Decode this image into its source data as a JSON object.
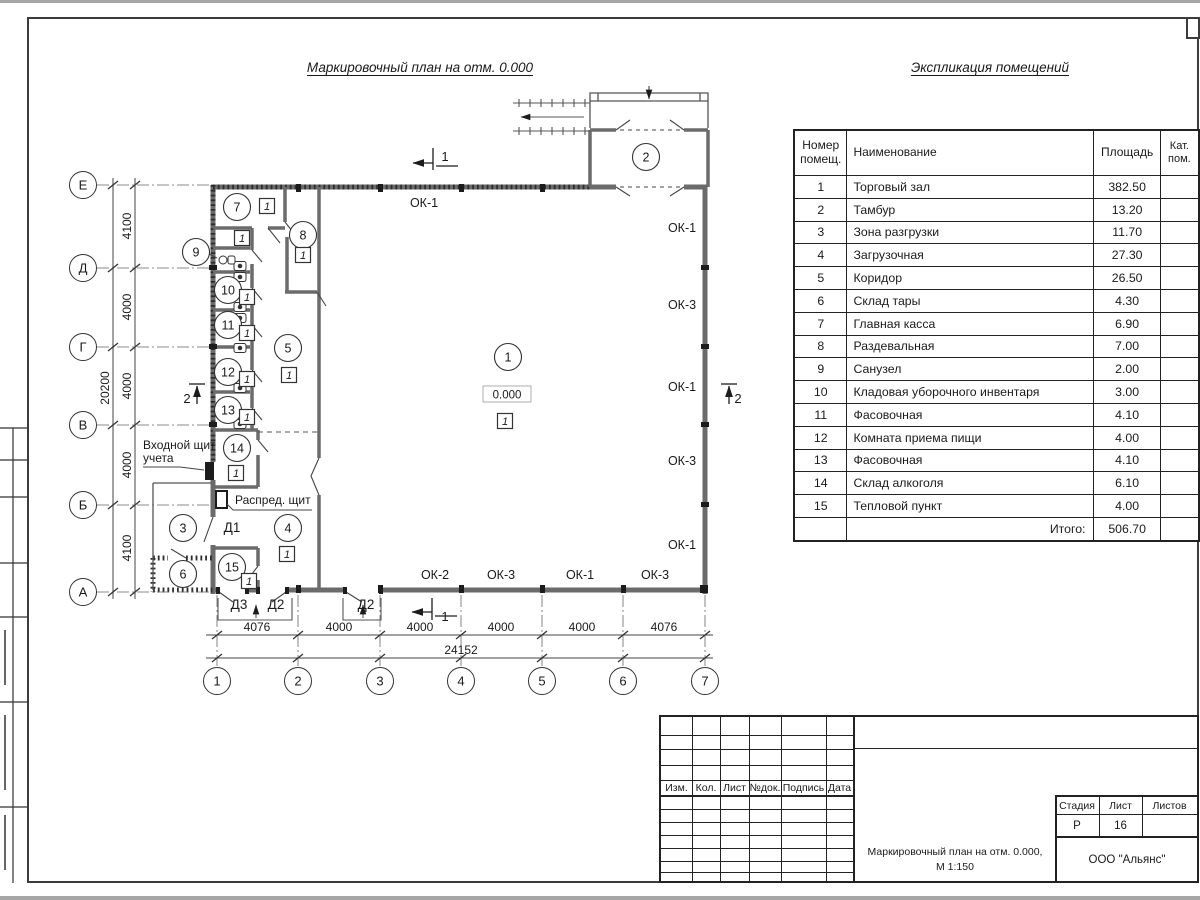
{
  "sheet": {
    "plan_title": "Маркировочный план на отм. 0.000",
    "explication_title": "Экспликация помещений"
  },
  "explication": {
    "headers": {
      "number": "Номер помещ.",
      "name": "Наименование",
      "area": "Площадь",
      "category": "Кат. пом."
    },
    "rows": [
      {
        "number": "1",
        "name": "Торговый зал",
        "area": "382.50",
        "category": ""
      },
      {
        "number": "2",
        "name": "Тамбур",
        "area": "13.20",
        "category": ""
      },
      {
        "number": "3",
        "name": "Зона разгрузки",
        "area": "11.70",
        "category": ""
      },
      {
        "number": "4",
        "name": "Загрузочная",
        "area": "27.30",
        "category": ""
      },
      {
        "number": "5",
        "name": "Коридор",
        "area": "26.50",
        "category": ""
      },
      {
        "number": "6",
        "name": "Склад тары",
        "area": "4.30",
        "category": ""
      },
      {
        "number": "7",
        "name": "Главная касса",
        "area": "6.90",
        "category": ""
      },
      {
        "number": "8",
        "name": "Раздевальная",
        "area": "7.00",
        "category": ""
      },
      {
        "number": "9",
        "name": "Санузел",
        "area": "2.00",
        "category": ""
      },
      {
        "number": "10",
        "name": "Кладовая уборочного инвентаря",
        "area": "3.00",
        "category": ""
      },
      {
        "number": "11",
        "name": "Фасовочная",
        "area": "4.10",
        "category": ""
      },
      {
        "number": "12",
        "name": "Комната приема пищи",
        "area": "4.00",
        "category": ""
      },
      {
        "number": "13",
        "name": "Фасовочная",
        "area": "4.10",
        "category": ""
      },
      {
        "number": "14",
        "name": "Склад алкоголя",
        "area": "6.10",
        "category": ""
      },
      {
        "number": "15",
        "name": "Тепловой пункт",
        "area": "4.00",
        "category": ""
      }
    ],
    "total_label": "Итого:",
    "total_value": "506.70"
  },
  "plan": {
    "elevation": "0.000",
    "category_mark": "1",
    "axis_rows": [
      {
        "label": "Е",
        "y": 185
      },
      {
        "label": "Д",
        "y": 268
      },
      {
        "label": "Г",
        "y": 347
      },
      {
        "label": "В",
        "y": 425
      },
      {
        "label": "Б",
        "y": 505
      },
      {
        "label": "А",
        "y": 592
      }
    ],
    "axis_cols": [
      {
        "label": "1",
        "x": 217
      },
      {
        "label": "2",
        "x": 298
      },
      {
        "label": "3",
        "x": 380
      },
      {
        "label": "4",
        "x": 461
      },
      {
        "label": "5",
        "x": 542
      },
      {
        "label": "6",
        "x": 623
      },
      {
        "label": "7",
        "x": 705
      }
    ],
    "dims_left": [
      {
        "text": "4100",
        "y": 226
      },
      {
        "text": "4000",
        "y": 307
      },
      {
        "text": "4000",
        "y": 386
      },
      {
        "text": "4000",
        "y": 465
      },
      {
        "text": "4100",
        "y": 548
      }
    ],
    "dim_left_total": {
      "text": "20200",
      "y": 388
    },
    "dims_bottom": [
      {
        "text": "4076",
        "x": 257
      },
      {
        "text": "4000",
        "x": 339
      },
      {
        "text": "4000",
        "x": 420
      },
      {
        "text": "4000",
        "x": 501
      },
      {
        "text": "4000",
        "x": 582
      },
      {
        "text": "4076",
        "x": 664
      }
    ],
    "dim_bottom_total": {
      "text": "24152",
      "x": 461
    },
    "room_circles": [
      {
        "n": "1",
        "x": 508,
        "y": 357
      },
      {
        "n": "2",
        "x": 646,
        "y": 157
      },
      {
        "n": "3",
        "x": 183,
        "y": 528
      },
      {
        "n": "4",
        "x": 288,
        "y": 528
      },
      {
        "n": "5",
        "x": 288,
        "y": 348
      },
      {
        "n": "6",
        "x": 183,
        "y": 574
      },
      {
        "n": "7",
        "x": 237,
        "y": 207
      },
      {
        "n": "8",
        "x": 303,
        "y": 235
      },
      {
        "n": "9",
        "x": 196,
        "y": 252
      },
      {
        "n": "10",
        "x": 228,
        "y": 290
      },
      {
        "n": "11",
        "x": 228,
        "y": 325
      },
      {
        "n": "12",
        "x": 228,
        "y": 372
      },
      {
        "n": "13",
        "x": 228,
        "y": 410
      },
      {
        "n": "14",
        "x": 237,
        "y": 448
      },
      {
        "n": "15",
        "x": 232,
        "y": 567
      }
    ],
    "category_squares": [
      {
        "x": 267,
        "y": 206
      },
      {
        "x": 242,
        "y": 238
      },
      {
        "x": 303,
        "y": 255
      },
      {
        "x": 247,
        "y": 297
      },
      {
        "x": 247,
        "y": 333
      },
      {
        "x": 247,
        "y": 379
      },
      {
        "x": 247,
        "y": 417
      },
      {
        "x": 236,
        "y": 473
      },
      {
        "x": 287,
        "y": 554
      },
      {
        "x": 249,
        "y": 581
      },
      {
        "x": 289,
        "y": 375
      },
      {
        "x": 505,
        "y": 421
      }
    ],
    "window_labels": [
      {
        "t": "ОК-1",
        "x": 424,
        "y": 207
      },
      {
        "t": "ОК-1",
        "x": 682,
        "y": 232
      },
      {
        "t": "ОК-3",
        "x": 682,
        "y": 309
      },
      {
        "t": "ОК-1",
        "x": 682,
        "y": 391
      },
      {
        "t": "ОК-3",
        "x": 682,
        "y": 465
      },
      {
        "t": "ОК-1",
        "x": 682,
        "y": 549
      },
      {
        "t": "ОК-2",
        "x": 435,
        "y": 579
      },
      {
        "t": "ОК-3",
        "x": 501,
        "y": 579
      },
      {
        "t": "ОК-1",
        "x": 580,
        "y": 579
      },
      {
        "t": "ОК-3",
        "x": 655,
        "y": 579
      }
    ],
    "door_labels": [
      {
        "t": "Д1",
        "x": 232,
        "y": 532
      },
      {
        "t": "Д3",
        "x": 239,
        "y": 609
      },
      {
        "t": "Д2",
        "x": 276,
        "y": 609
      },
      {
        "t": "Д2",
        "x": 366,
        "y": 609
      }
    ],
    "section_marks": [
      {
        "text": "1",
        "tx": 445,
        "ty": 161,
        "lines": [
          [
            433,
            148,
            433,
            170
          ],
          [
            436,
            166,
            458,
            166
          ]
        ],
        "arrow": [
          433,
          163,
          413,
          163
        ]
      },
      {
        "text": "1",
        "tx": 445,
        "ty": 621,
        "lines": [
          [
            432,
            598,
            432,
            620
          ],
          [
            435,
            616,
            457,
            616
          ]
        ],
        "arrow": [
          432,
          612,
          412,
          612
        ]
      },
      {
        "text": "2",
        "tx": 187,
        "ty": 403,
        "lines": [
          [
            189,
            384,
            205,
            384
          ]
        ],
        "arrow": [
          197,
          404,
          197,
          386
        ]
      },
      {
        "text": "2",
        "tx": 738,
        "ty": 403,
        "lines": [
          [
            721,
            384,
            737,
            384
          ]
        ],
        "arrow": [
          729,
          404,
          729,
          386
        ]
      }
    ],
    "notes": [
      {
        "lines": [
          "Входной щит",
          "учета"
        ],
        "x": 143,
        "y": 449,
        "leads": [
          [
            143,
            467,
            180,
            467
          ],
          [
            180,
            467,
            204,
            470
          ]
        ]
      },
      {
        "lines": [
          "Распред. щит"
        ],
        "x": 235,
        "y": 504,
        "leads": [
          [
            233,
            510,
            312,
            510
          ],
          [
            233,
            510,
            227,
            504
          ]
        ]
      }
    ]
  },
  "title_block": {
    "revision_headers": [
      "Изм.",
      "Кол.",
      "Лист",
      "№док.",
      "Подпись",
      "Дата"
    ],
    "stage_label": "Стадия",
    "sheet_label": "Лист",
    "sheets_label": "Листов",
    "stage_value": "Р",
    "sheet_value": "16",
    "sheets_value": "",
    "doc_title_line1": "Маркировочный план на отм. 0.000,",
    "doc_title_line2": "М 1:150",
    "company": "ООО \"Альянс\""
  }
}
